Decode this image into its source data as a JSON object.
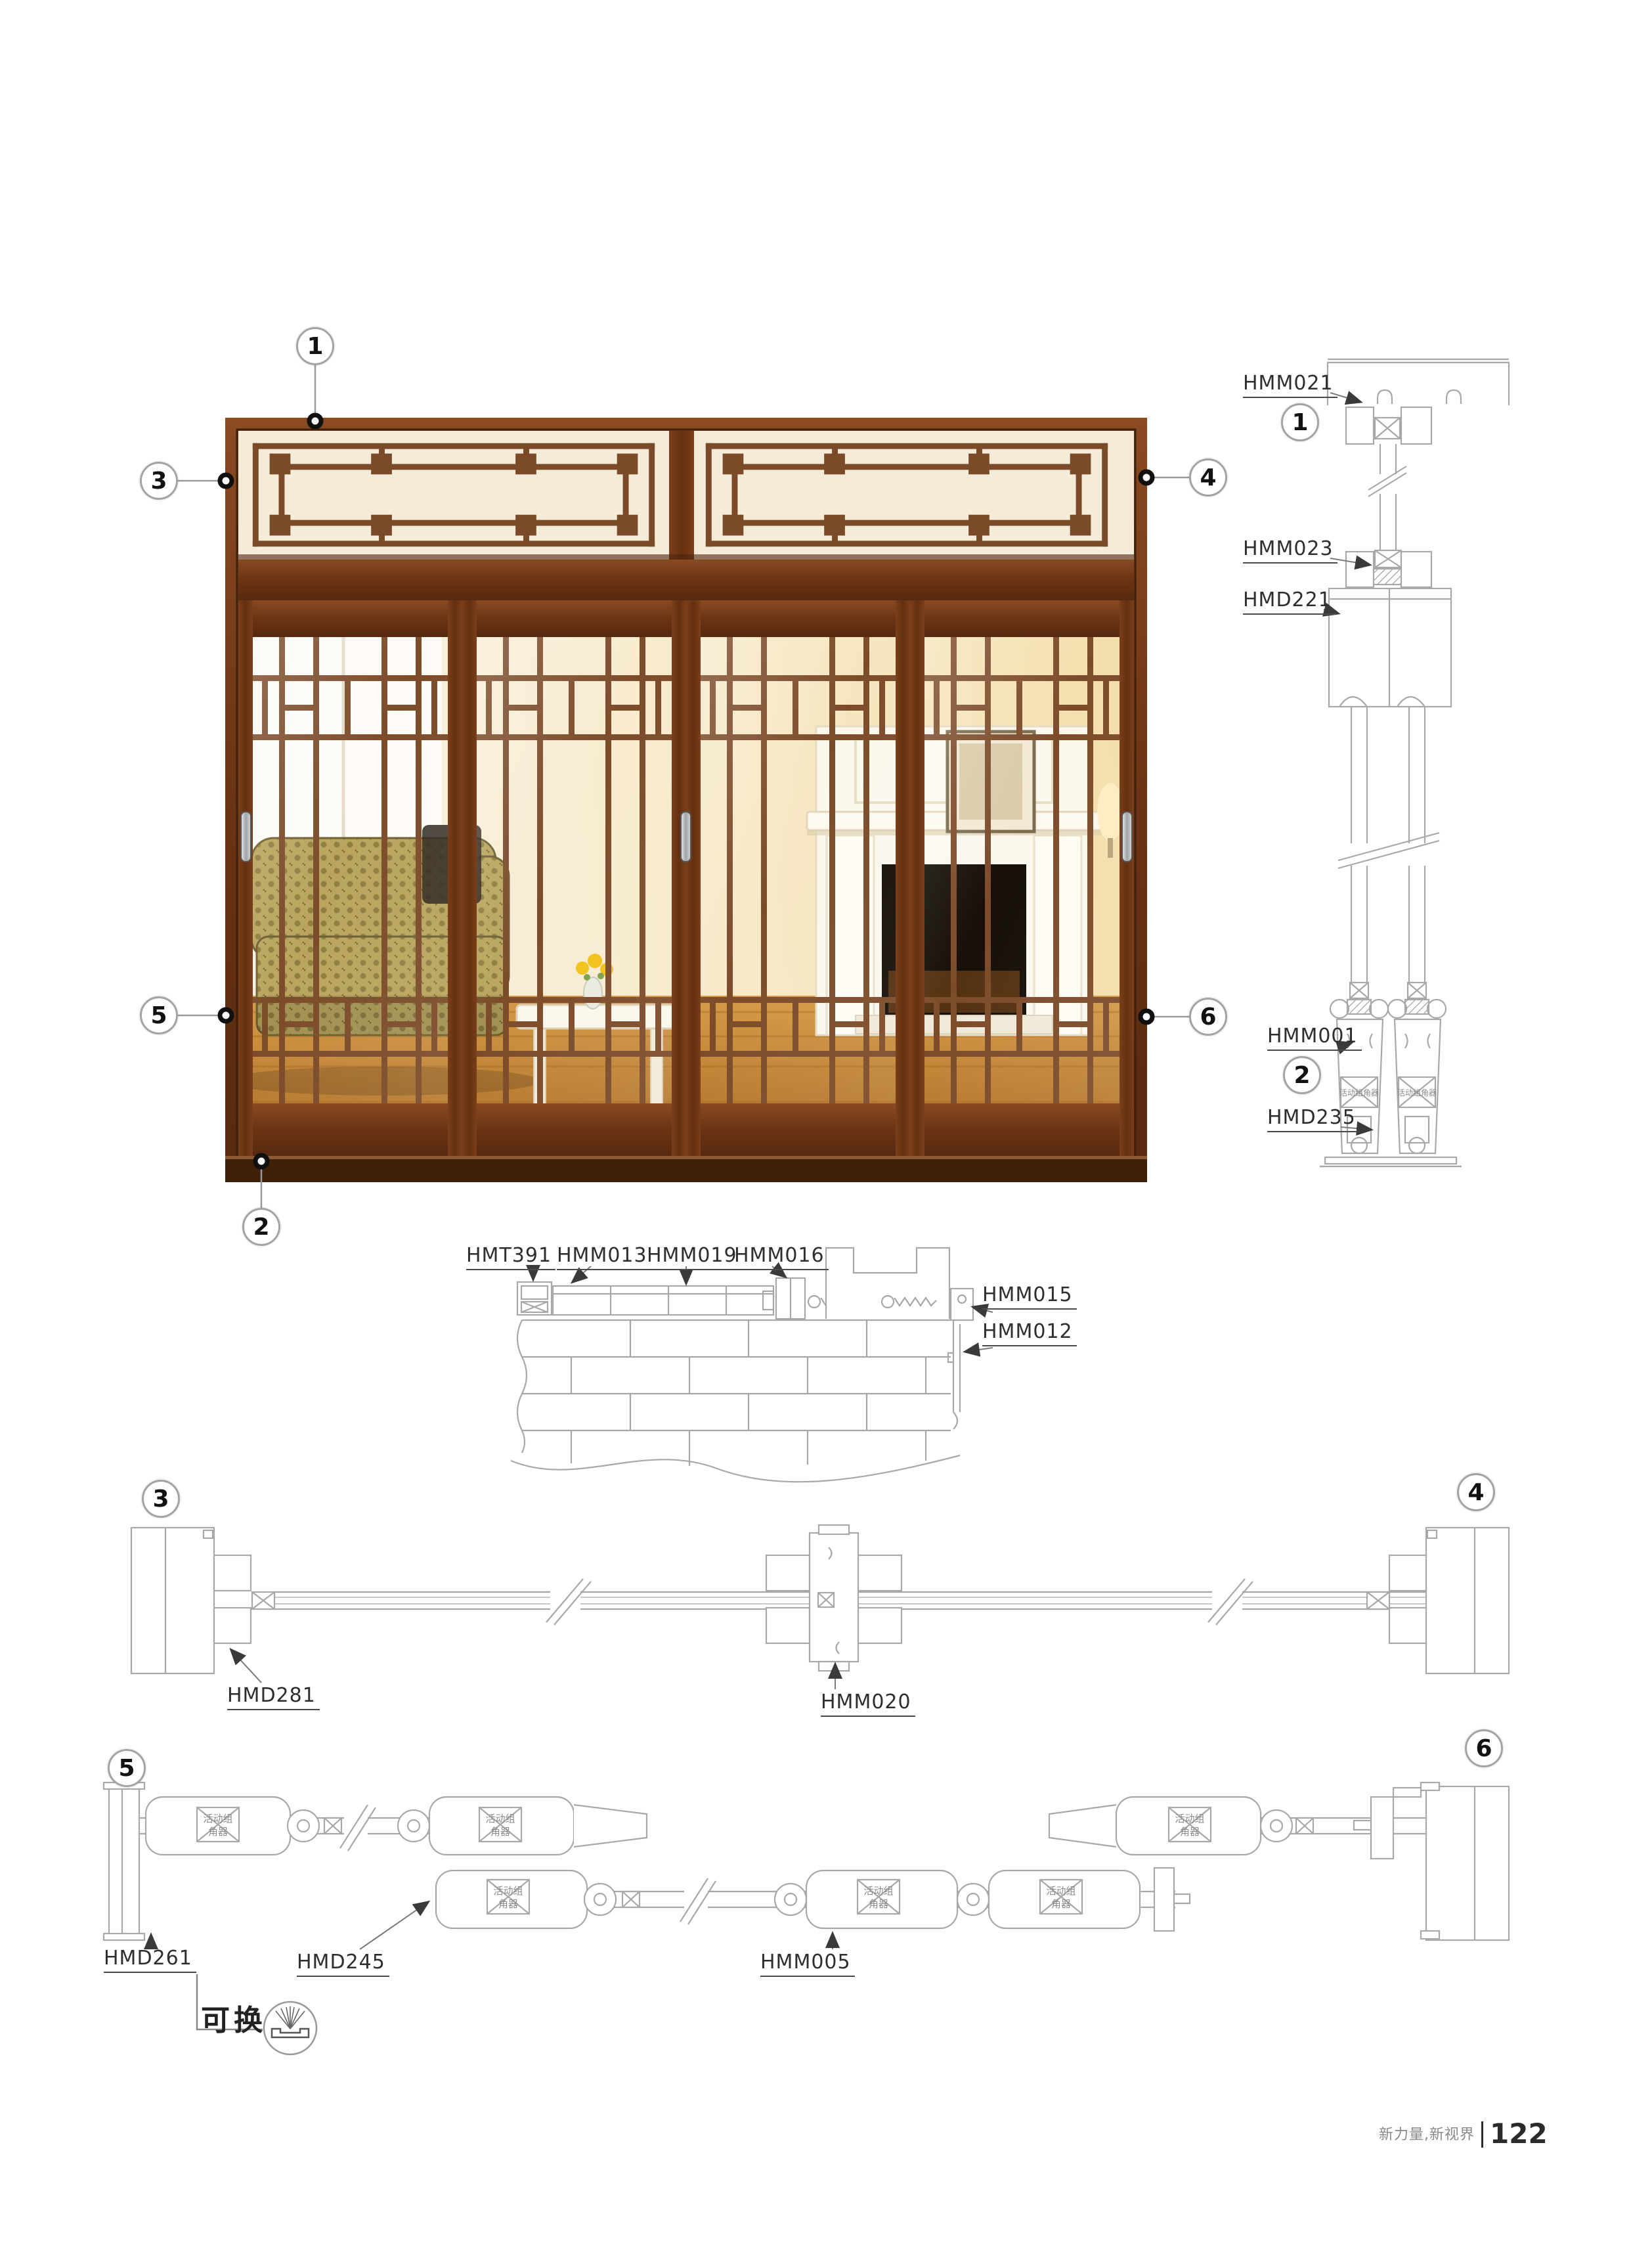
{
  "page": {
    "footer": {
      "brand": "新力量,新视界",
      "page_number": "122"
    }
  },
  "photo": {
    "callouts": {
      "c1": "1",
      "c2": "2",
      "c3": "3",
      "c4": "4",
      "c5": "5",
      "c6": "6"
    }
  },
  "sections": {
    "vertical": {
      "callout_top": "1",
      "callout_bottom": "2",
      "labels": {
        "hmm021": "HMM021",
        "hmm023": "HMM023",
        "hmd221": "HMD221",
        "hmm001": "HMM001",
        "hmd235": "HMD235"
      }
    },
    "head": {
      "labels": {
        "hmt391": "HMT391",
        "hmm013": "HMM013",
        "hmm019": "HMM019",
        "hmm016": "HMM016",
        "hmm015": "HMM015",
        "hmm012": "HMM012"
      }
    },
    "row34": {
      "callout_left": "3",
      "callout_right": "4",
      "labels": {
        "hmd281": "HMD281",
        "hmm020": "HMM020"
      }
    },
    "row56": {
      "callout_left": "5",
      "callout_right": "6",
      "labels": {
        "hmd261": "HMD261",
        "hmd245": "HMD245",
        "hmm005": "HMM005"
      }
    }
  },
  "annotations": {
    "replaceable": "可换",
    "corner_connector": "活动组角器",
    "corner_connector_l1": "活动组",
    "corner_connector_l2": "角器"
  },
  "colors": {
    "wood_dark": "#5a2a10",
    "wood_light": "#8a4a22",
    "lattice": "#7b4a28",
    "cream": "#f4ecd8",
    "drawing_line": "#a8a8a8",
    "label_text": "#2e2e2e"
  }
}
